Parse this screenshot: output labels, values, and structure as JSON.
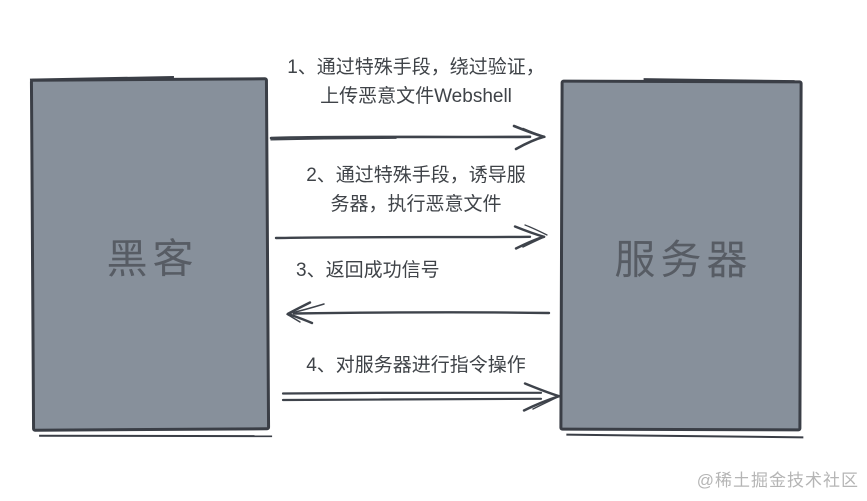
{
  "diagram": {
    "title_context": "Webshell attack sequence diagram",
    "actors": {
      "left": {
        "label": "黑客"
      },
      "right": {
        "label": "服务器"
      }
    },
    "steps": [
      {
        "number": "1",
        "direction": "right",
        "lines": [
          "1、通过特殊手段，绕过验证，",
          "上传恶意文件Webshell"
        ]
      },
      {
        "number": "2",
        "direction": "right",
        "lines": [
          "2、通过特殊手段，诱导服",
          "务器，执行恶意文件"
        ]
      },
      {
        "number": "3",
        "direction": "left",
        "lines": [
          "3、返回成功信号"
        ]
      },
      {
        "number": "4",
        "direction": "right",
        "lines": [
          "4、对服务器进行指令操作"
        ]
      }
    ],
    "watermark": "@稀土掘金技术社区",
    "colors": {
      "background": "#FFFFFF",
      "box_fill": "#87909B",
      "box_border": "#3A3E46",
      "box_label": "#575C64",
      "step_text": "#3F4348",
      "arrow": "#3E434B",
      "watermark": "#B5B5B5"
    }
  }
}
